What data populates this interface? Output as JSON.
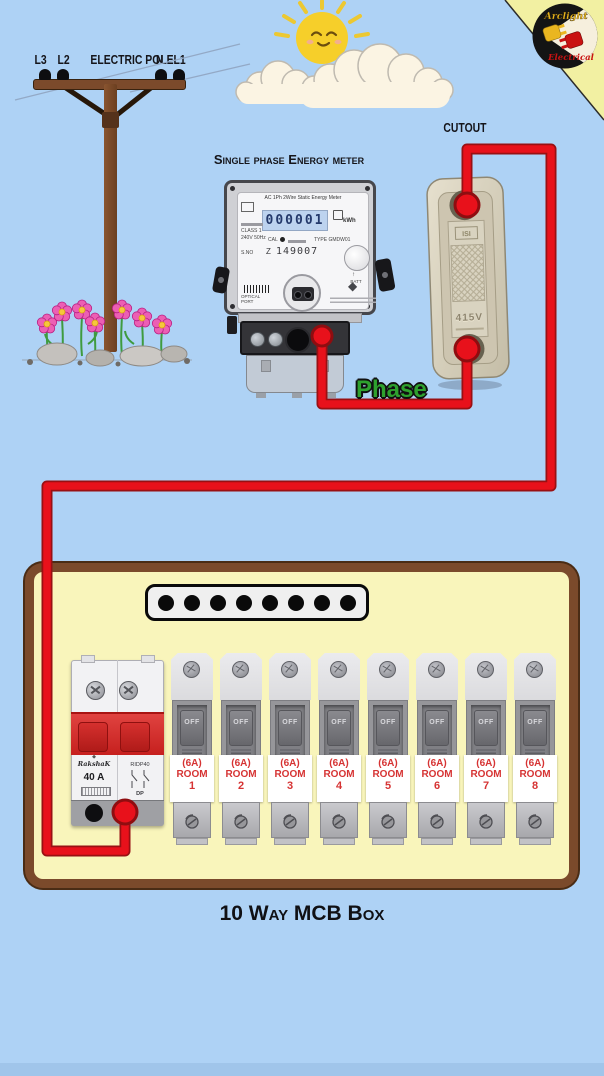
{
  "logo": {
    "top": "Arclight",
    "bottom": "Electrical"
  },
  "pole": {
    "title": "ELECTRIC POLE",
    "wires": [
      "L3",
      "L2",
      "N",
      "L1"
    ]
  },
  "meter": {
    "title": "Single phase Energy meter",
    "header": "AC 1Ph 2Wire Static Energy Meter",
    "display": "000001",
    "unit": "kWh",
    "class_text": "CLASS 1",
    "rating_text": "240V 50Hz",
    "cal": "CAL",
    "type_text": "TYPE GMDW01",
    "sno": "S.NO",
    "serial_prefix": "Z",
    "serial": "149007",
    "batt": "BATT",
    "optical_line1": "OPTICAL",
    "optical_line2": "PORT"
  },
  "cutout": {
    "label": "CUTOUT",
    "mark_top": "ISI",
    "mark_voltage": "415V"
  },
  "wiring": {
    "phase_label": "Phase"
  },
  "mcb_box": {
    "caption": "10 Way MCB Box",
    "busbar_holes": 8,
    "main_breaker": {
      "brand": "RakshaK",
      "rating": "40 A",
      "model": "RIDP40",
      "poles": "DP"
    },
    "breakers": [
      {
        "amp": "(6A)",
        "room": "ROOM",
        "number": "1",
        "switch": "OFF"
      },
      {
        "amp": "(6A)",
        "room": "ROOM",
        "number": "2",
        "switch": "OFF"
      },
      {
        "amp": "(6A)",
        "room": "ROOM",
        "number": "3",
        "switch": "OFF"
      },
      {
        "amp": "(6A)",
        "room": "ROOM",
        "number": "4",
        "switch": "OFF"
      },
      {
        "amp": "(6A)",
        "room": "ROOM",
        "number": "5",
        "switch": "OFF"
      },
      {
        "amp": "(6A)",
        "room": "ROOM",
        "number": "6",
        "switch": "OFF"
      },
      {
        "amp": "(6A)",
        "room": "ROOM",
        "number": "7",
        "switch": "OFF"
      },
      {
        "amp": "(6A)",
        "room": "ROOM",
        "number": "8",
        "switch": "OFF"
      }
    ]
  },
  "colors": {
    "sky": "#aed2f5",
    "wire_red": "#e8111b",
    "box_fill": "#f9f5bb",
    "box_border": "#7b4a2b",
    "breaker_red": "#d5312f",
    "label_red": "#d63333",
    "phase_green": "#2ea12e",
    "corner_yellow": "#f2f0a2"
  }
}
